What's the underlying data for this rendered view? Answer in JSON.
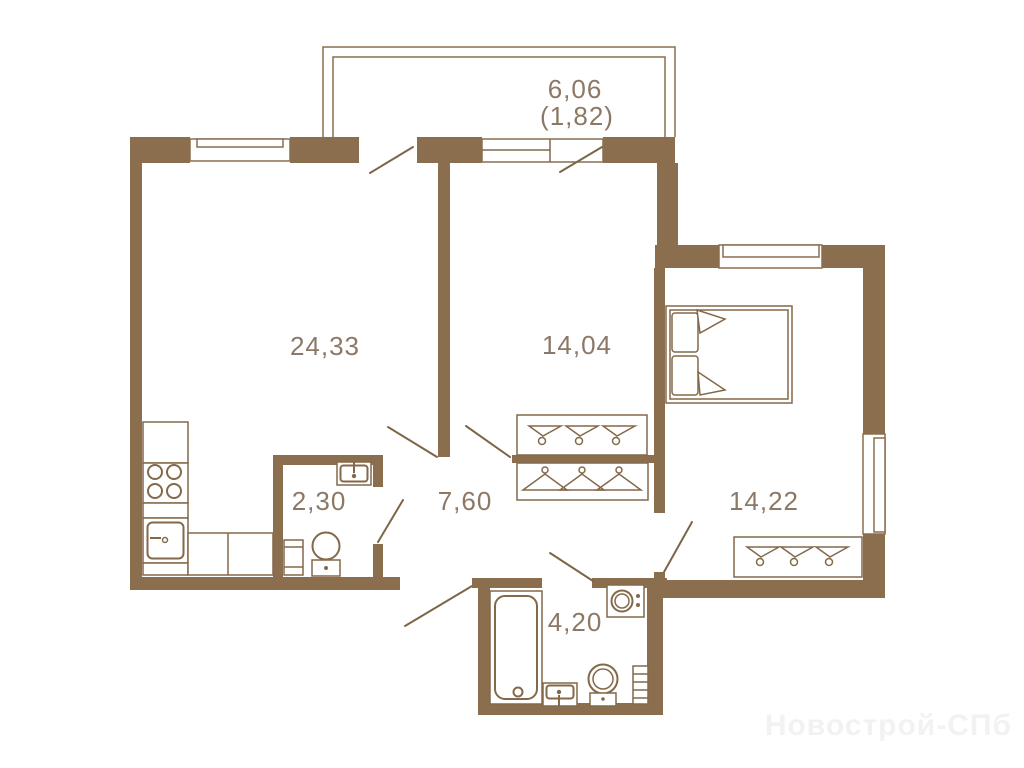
{
  "floorplan": {
    "rooms": [
      {
        "id": "balcony",
        "area": "6,06",
        "area_secondary": "(1,82)"
      },
      {
        "id": "kitchen-living-room",
        "area": "24,33"
      },
      {
        "id": "room",
        "area": "14,04"
      },
      {
        "id": "bedroom",
        "area": "14,22"
      },
      {
        "id": "hallway",
        "area": "7,60"
      },
      {
        "id": "wc",
        "area": "2,30"
      },
      {
        "id": "bathroom",
        "area": "4,20"
      }
    ],
    "watermark": "Новострой-СПб",
    "colors": {
      "wall": "#8a6e4e",
      "furniture_line": "#83694a",
      "door_leaf": "#7d6647",
      "label_text": "#8c7866",
      "watermark_text": "#f2f2f2",
      "background": "#ffffff"
    }
  }
}
